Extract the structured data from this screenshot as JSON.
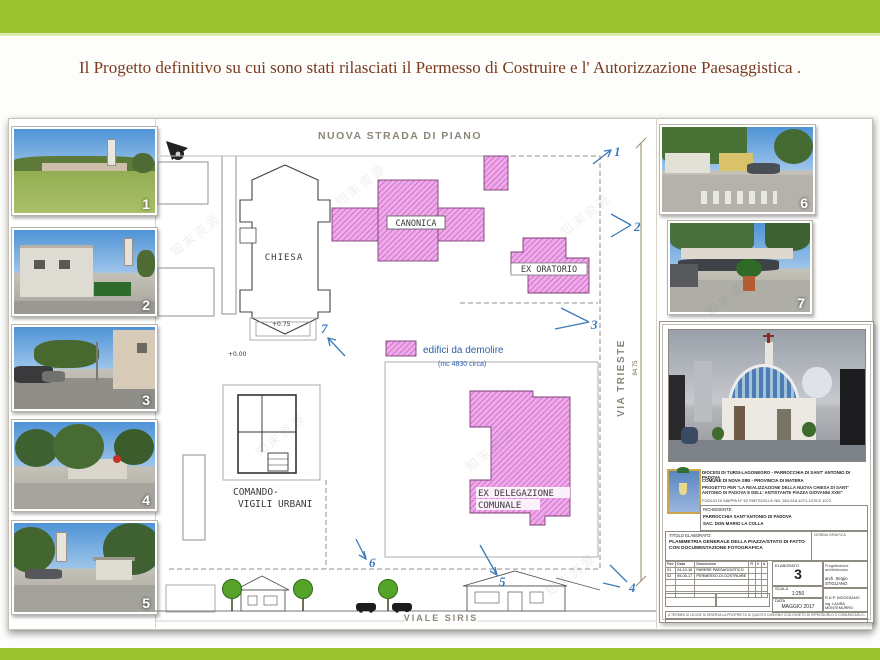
{
  "slide": {
    "title": "Il Progetto definitivo su cui sono stati rilasciati il Permesso di Costruire e l' Autorizzazione Paesaggistica .",
    "watermark": "知末资源",
    "accent_green": "#9cc32f",
    "title_color": "#7a3b1e"
  },
  "left_photos": [
    {
      "label": "1"
    },
    {
      "label": "2"
    },
    {
      "label": "3"
    },
    {
      "label": "4"
    },
    {
      "label": "5"
    }
  ],
  "right_photos": [
    {
      "label": "6"
    },
    {
      "label": "7"
    }
  ],
  "plan": {
    "street_top": "NUOVA STRADA DI PIANO",
    "street_right": "VIA TRIESTE",
    "street_bottom": "VIALE SIRIS",
    "dimension_value": "84.75",
    "labels": {
      "chiesa": "CHIESA",
      "canonica": "CANONICA",
      "ex_oratorio": "EX ORATORIO",
      "comando_line1": "COMANDO-",
      "comando_line2": "VIGILI URBANI",
      "delegazione_line1": "EX DELEGAZIONE",
      "delegazione_line2": "COMUNALE"
    },
    "legend": {
      "label": "edifici da demolire",
      "note": "(mc 4830 circa)"
    },
    "elevations": {
      "chiesa": "+0.75",
      "sagrato": "+0.00"
    },
    "markers": [
      "1",
      "2",
      "3",
      "4",
      "5",
      "6",
      "7"
    ]
  },
  "titleblock": {
    "header_line1": "DIOCESI DI TURSI-LAGONEGRO  -  PARROCCHIA DI SANT' ANTONIO DI PADOVA",
    "header_line2": "COMUNE DI NOVA SIRI - PROVINCIA DI MATERA",
    "header_line3": "PROGETTO PER \"LA REALIZZAZIONE DELLA NUOVA CHIESA DI SANT' ANTONIO DI PADOVA E DELL' ANTISTANTE PIAZZA GIOVANNI XXIII\"",
    "header_line4": "FOGLIO DI MAPPA N° 62 PARTICELLE NN. 264-918-1071-1076 E 1072",
    "richiedente_label": "RICHIEDENTE:",
    "richiedente_line1": "PARROCCHIA SANT'ANTONIO DI PADOVA",
    "richiedente_line2": "SAC. DON MARIO LA COLLA",
    "titolo_label": "TITOLO ELABORATO:",
    "norma_label": "NORMA GRAFICA",
    "titolo_value": "PLANIMETRIA GENERALE DELLA PIAZZA/STATO DI FATTO CON DOCUMENTAZIONE FOTOGRAFICA",
    "table": {
      "headers": [
        "Rev",
        "Data",
        "Descrizione",
        "R",
        "V",
        "A"
      ],
      "rows": [
        [
          "01",
          "24-10-16",
          "PARERE PAESAGGISTICO"
        ],
        [
          "02",
          "09-05-17",
          "PERMESSO DI COSTRUIRE"
        ]
      ]
    },
    "elaborato_label": "ELABORATO",
    "elaborato_value": "3",
    "scala_label": "SCALA",
    "scala_value": "1:250",
    "data_label": "DATA",
    "data_value": "MAGGIO 2017",
    "arch_role": "Progettazione architettonica",
    "arch_name": "arch. Sergio STIGLIANO",
    "rup_role": "R.U.P. DIOCESANO",
    "rup_name": "ing. LAURA MONTEMURRO",
    "footer_note": "A TERMINI DI LEGGE SI RISERVA LA PROPRIETÀ DI QUESTO DISEGNO CON DIVIETO DI RIPRODURLO O COMUNICARLO A TERZI"
  }
}
